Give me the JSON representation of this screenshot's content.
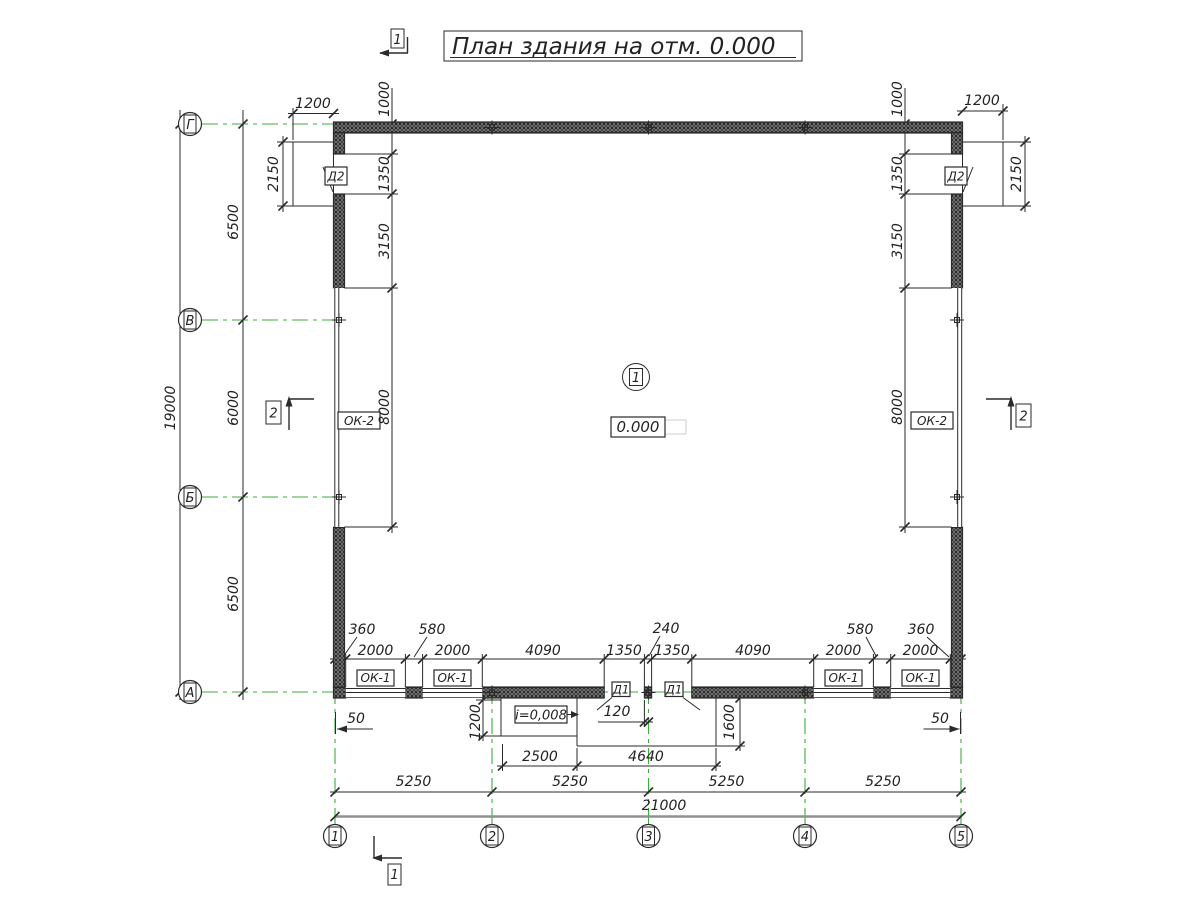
{
  "title": "План здания на отм. 0.000",
  "colors": {
    "axis_green": "#3cae3c",
    "ink": "#2a2a2a",
    "overall_dim_line": "#909090"
  },
  "grid": {
    "letters": [
      "Г",
      "В",
      "Б",
      "А"
    ],
    "numbers": [
      "1",
      "2",
      "3",
      "4",
      "5"
    ]
  },
  "sections": {
    "s1": "1",
    "s2": "2"
  },
  "room": {
    "number": "1",
    "level": "0.000",
    "slope": "i=0,008"
  },
  "marks": {
    "d1": "Д1",
    "d2": "Д2",
    "ok1": "ОК-1",
    "ok2": "ОК-2"
  },
  "dims": {
    "overall_width": "21000",
    "overall_height": "19000",
    "bays": [
      "5250",
      "5250",
      "5250",
      "5250"
    ],
    "rows": [
      "6500",
      "6000",
      "6500"
    ],
    "porch_width": "1200",
    "porch_depth": "2150",
    "side_top_offset": "1000",
    "side_door": "1350",
    "side_pier": "3150",
    "side_window": "8000",
    "bottom_chain": [
      "360",
      "2000",
      "580",
      "2000",
      "4090",
      "1350",
      "240",
      "1350",
      "4090",
      "2000",
      "580",
      "2000",
      "360"
    ],
    "corner_offset": "50",
    "pier_half": "120",
    "ramp_depth": "1200",
    "landing_depth": "1600",
    "ramp_width": "2500",
    "landing_width": "4640"
  }
}
